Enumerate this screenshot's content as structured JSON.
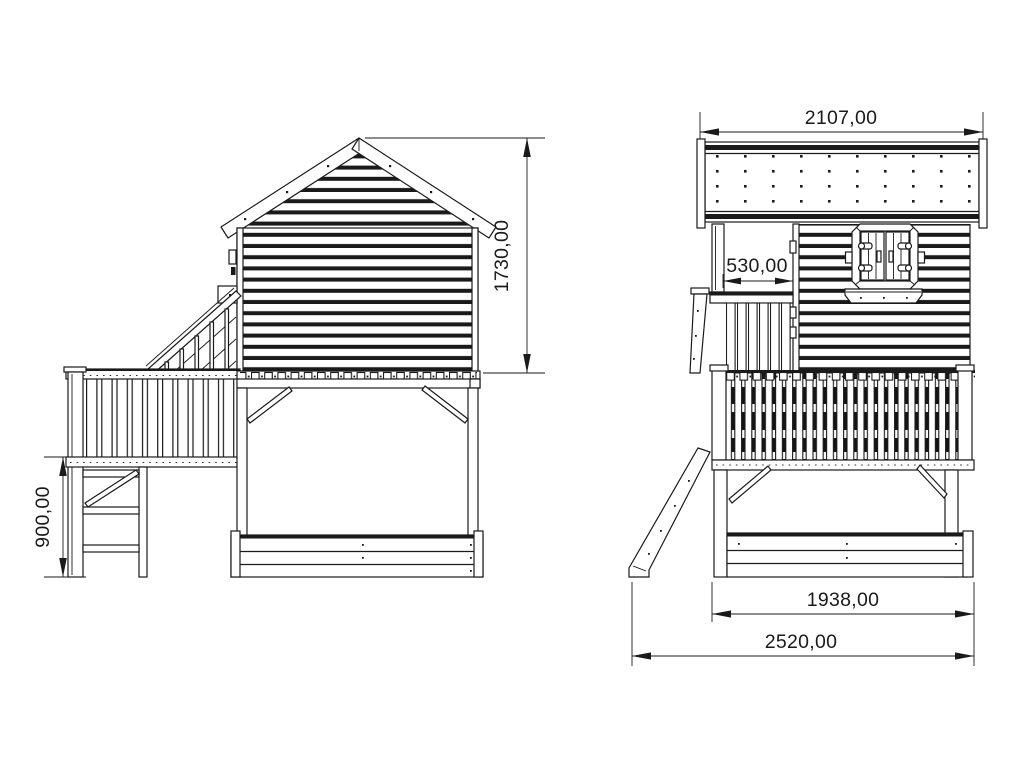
{
  "drawing": {
    "type": "technical-elevation-drawing",
    "subject": "stilted-playhouse-with-slide-ladder-and-sandbox",
    "background_color": "#ffffff",
    "line_color": "#1a1a1a",
    "views": {
      "side_view": {
        "name": "side elevation"
      },
      "front_view": {
        "name": "front elevation"
      }
    },
    "dimensions": {
      "house_height": "1730,00",
      "platform_height": "900,00",
      "roof_width": "2107,00",
      "porch_opening": "530,00",
      "base_width": "1938,00",
      "total_width": "2520,00"
    }
  }
}
